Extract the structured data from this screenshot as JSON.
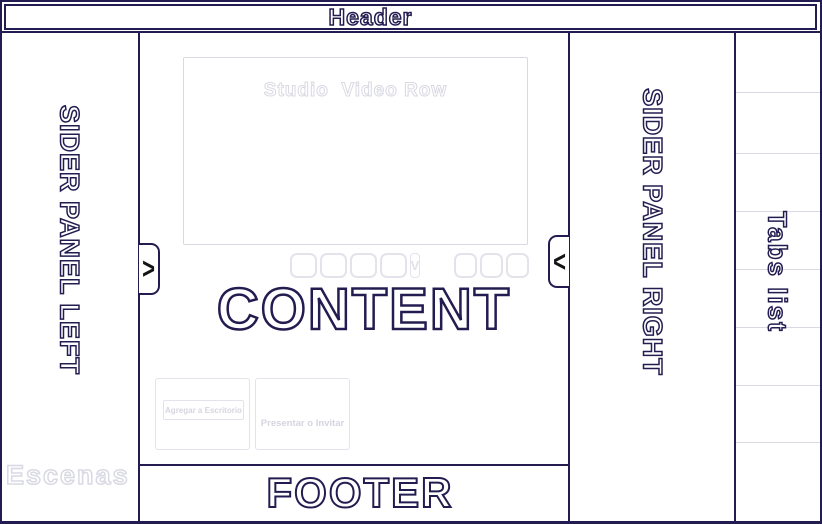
{
  "header": {
    "title": "Header"
  },
  "left_panel": {
    "title": "SIDER PANEL LEFT",
    "scenes_label": "Escenas",
    "expand_handle_glyph": ">"
  },
  "right_panel": {
    "title": "SIDER PANEL RIGHT",
    "collapse_handle_glyph": "<"
  },
  "tabs_panel": {
    "title": "Tabs list",
    "cell_count": 8
  },
  "content": {
    "title": "CONTENT",
    "video_row_label": "Studio  Video Row",
    "thumbnail_dropdown_glyph": "V",
    "cards": {
      "add_to_desktop_label": "Agregar a Escritorio",
      "present_or_invite_label": "Presentar o Invitar"
    }
  },
  "footer": {
    "title": "FOOTER"
  },
  "colors": {
    "outline_navy": "#221c50",
    "outline_gray": "#d9d9e3"
  }
}
